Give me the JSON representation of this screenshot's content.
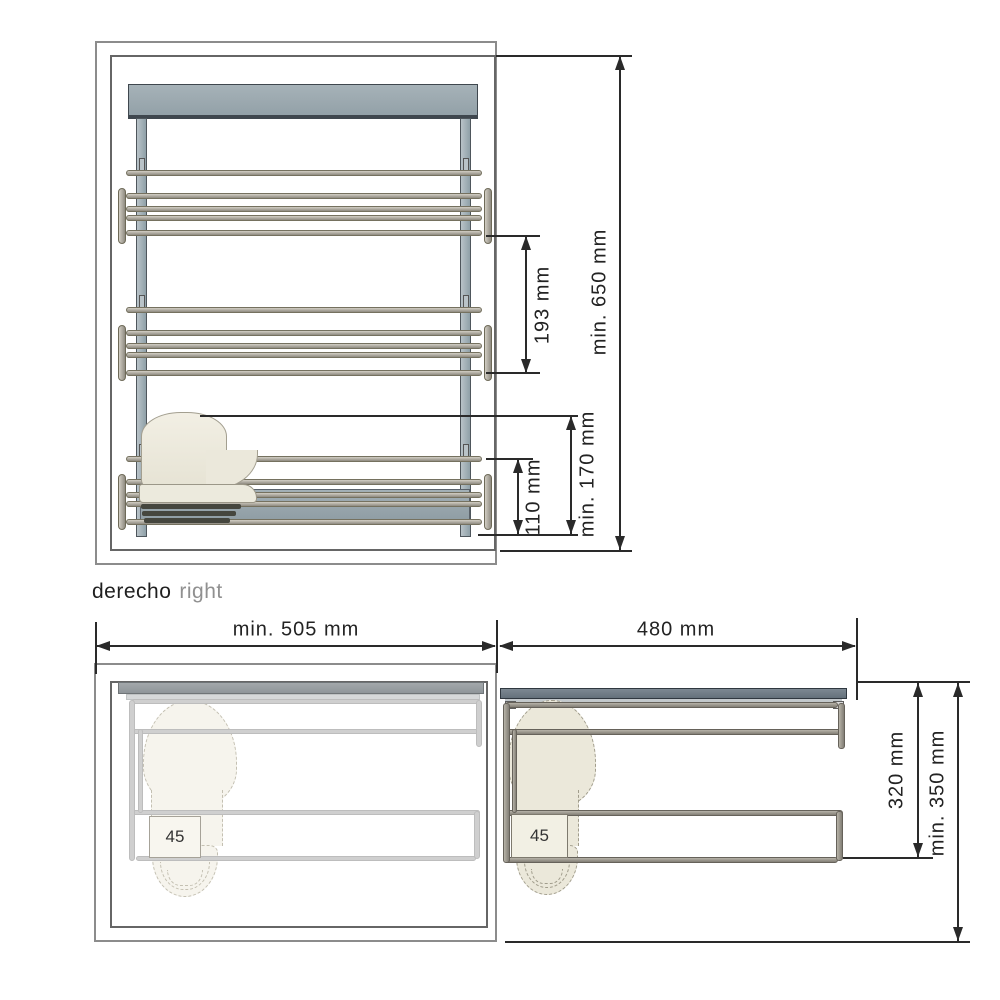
{
  "caption": {
    "primary": "derecho",
    "secondary": "right"
  },
  "front_view": {
    "dim_tier_spacing": "193 mm",
    "dim_total_height": "min. 650 mm",
    "dim_bottom_rack_height": "110 mm",
    "dim_bottom_clearance": "min. 170 mm"
  },
  "plan_view_closed": {
    "dim_depth": "min. 505 mm",
    "shoe_size_label": "45"
  },
  "plan_view_extended": {
    "dim_extension": "480 mm",
    "dim_rack_depth": "320 mm",
    "dim_min_depth": "min. 350 mm",
    "shoe_size_label": "45"
  },
  "colors": {
    "line": "#2a2a2a",
    "cabinet_outline": "#8c8c8c",
    "panel_blue_gray": "#9aa7ae",
    "rod_taupe": "#a7a095",
    "ghost_gray": "#cfcfcf",
    "shoe_cream": "#f0ede0",
    "slate_bar": "#6e7b85"
  }
}
